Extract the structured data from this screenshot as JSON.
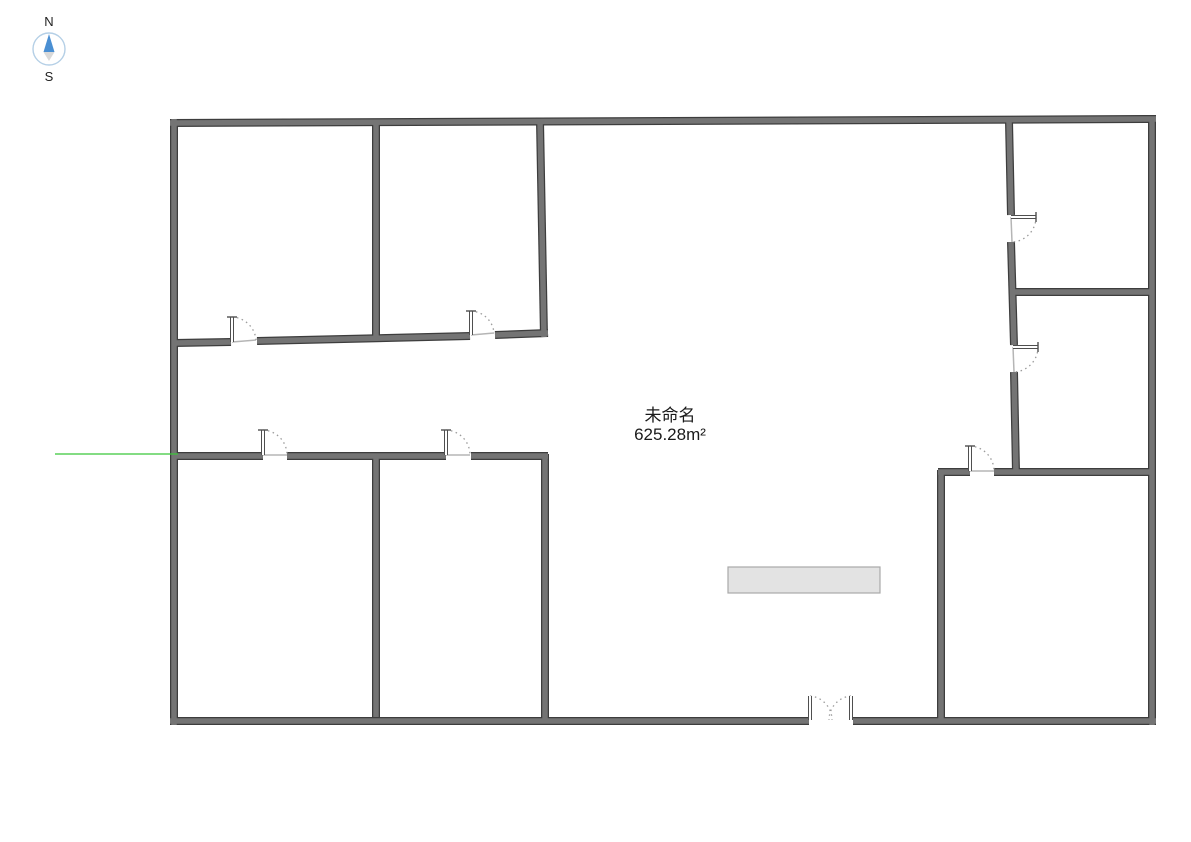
{
  "compass": {
    "north_label": "N",
    "south_label": "S",
    "ring_color": "#b4cfe6",
    "needle_north_color": "#4a8fd3",
    "needle_south_color": "#d9d9d9",
    "label_color": "#222222"
  },
  "room_label": {
    "name": "未命名",
    "area": "625.28m²"
  },
  "colors": {
    "background": "#ffffff",
    "wall_fill": "#747474",
    "wall_edge": "#3d3d3d",
    "door_leaf": "#4f4f4f",
    "door_leaf_core": "#ffffff",
    "door_arc": "#9b9b9b",
    "door_sill": "#b5b5b5",
    "guide_line": "#39c839",
    "furniture_fill": "#e3e3e3",
    "furniture_edge": "#a9a9a9",
    "label_text": "#1a1a1a"
  },
  "floorplan": {
    "canvas": {
      "width": 1191,
      "height": 842
    },
    "walls": [
      [
        174,
        119,
        174,
        725
      ],
      [
        170,
        123,
        1156,
        119
      ],
      [
        1152,
        119,
        1152,
        725
      ],
      [
        170,
        721,
        809,
        721
      ],
      [
        853,
        721,
        1156,
        721
      ],
      [
        376,
        121,
        376,
        340
      ],
      [
        174,
        343,
        231,
        342
      ],
      [
        257,
        341,
        470,
        336
      ],
      [
        495,
        335,
        548,
        333
      ],
      [
        540,
        121,
        544,
        337
      ],
      [
        1009,
        121,
        1011,
        215
      ],
      [
        1011,
        242,
        1014,
        345
      ],
      [
        1014,
        372,
        1016,
        472
      ],
      [
        1011,
        292,
        1153,
        292
      ],
      [
        938,
        472,
        970,
        472
      ],
      [
        994,
        472,
        1153,
        472
      ],
      [
        941,
        470,
        941,
        723
      ],
      [
        174,
        456,
        263,
        456
      ],
      [
        287,
        456,
        446,
        456
      ],
      [
        471,
        456,
        548,
        456
      ],
      [
        545,
        454,
        545,
        723
      ],
      [
        376,
        458,
        376,
        717
      ]
    ],
    "doors": [
      {
        "hinge": [
          232,
          342
        ],
        "tip": [
          232,
          317
        ],
        "jamb": [
          256,
          340
        ],
        "sweep": 1
      },
      {
        "hinge": [
          471,
          335
        ],
        "tip": [
          471,
          311
        ],
        "jamb": [
          494,
          333
        ],
        "sweep": 1
      },
      {
        "hinge": [
          263,
          455
        ],
        "tip": [
          263,
          430
        ],
        "jamb": [
          287,
          455
        ],
        "sweep": 1
      },
      {
        "hinge": [
          446,
          455
        ],
        "tip": [
          446,
          430
        ],
        "jamb": [
          470,
          455
        ],
        "sweep": 1
      },
      {
        "hinge": [
          1011,
          217
        ],
        "tip": [
          1036,
          217
        ],
        "jamb": [
          1012,
          242
        ],
        "sweep": 1
      },
      {
        "hinge": [
          1013,
          347
        ],
        "tip": [
          1038,
          347
        ],
        "jamb": [
          1014,
          372
        ],
        "sweep": 1
      },
      {
        "hinge": [
          970,
          471
        ],
        "tip": [
          970,
          446
        ],
        "jamb": [
          994,
          471
        ],
        "sweep": 1
      }
    ],
    "double_door": {
      "leaves": [
        [
          810,
          720,
          810,
          696
        ],
        [
          851,
          720,
          851,
          696
        ]
      ],
      "arcs": [
        {
          "from": [
            810,
            696
          ],
          "to": [
            832,
            720
          ],
          "r": 24,
          "sweep": 1
        },
        {
          "from": [
            851,
            696
          ],
          "to": [
            829,
            720
          ],
          "r": 24,
          "sweep": 0
        }
      ]
    },
    "furniture": {
      "x": 728,
      "y": 567,
      "w": 152,
      "h": 26
    },
    "guide_line": {
      "x1": 55,
      "y1": 454,
      "x2": 178,
      "y2": 454
    }
  }
}
